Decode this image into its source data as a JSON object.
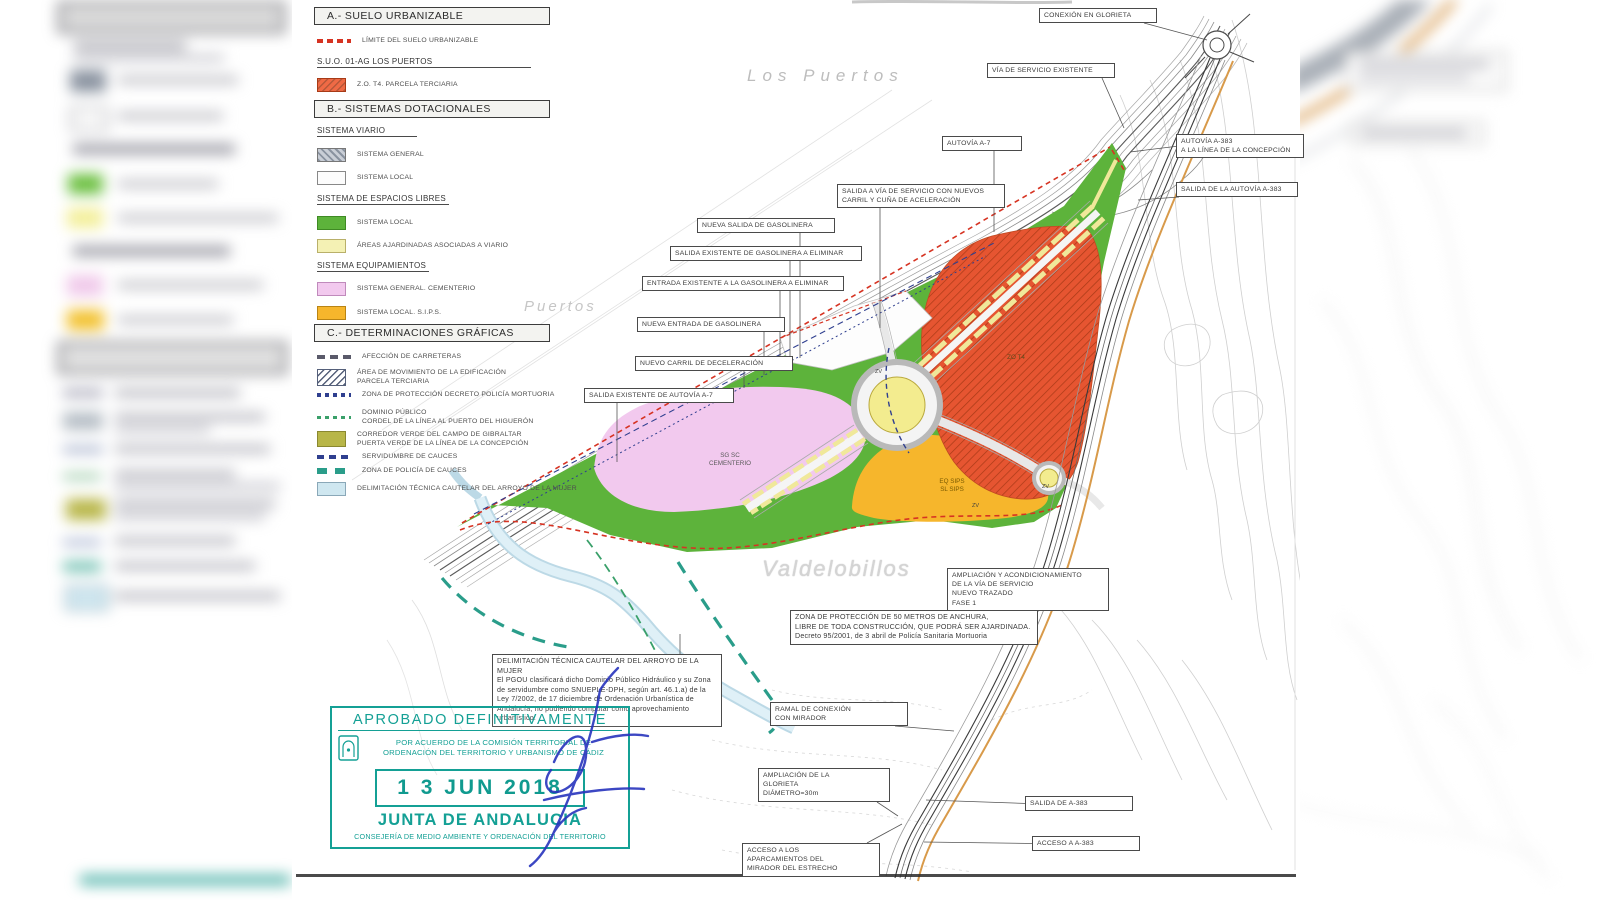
{
  "legend": {
    "header_a": "A.- SUELO URBANIZABLE",
    "limite": "LÍMITE DEL SUELO URBANIZABLE",
    "suo": "S.U.O. 01-AG  LOS PUERTOS",
    "zo_t4": "Z.O. T4. PARCELA TERCIARIA",
    "header_b": "B.- SISTEMAS DOTACIONALES",
    "viario_title": "SISTEMA VIARIO",
    "viario_general": "SISTEMA GENERAL",
    "viario_local": "SISTEMA LOCAL",
    "libres_title": "SISTEMA DE ESPACIOS LIBRES",
    "libres_local": "SISTEMA LOCAL",
    "libres_ajardinadas": "ÁREAS AJARDINADAS ASOCIADAS A VIARIO",
    "equip_title": "SISTEMA EQUIPAMIENTOS",
    "equip_cementerio": "SISTEMA GENERAL. CEMENTERIO",
    "equip_sips": "SISTEMA LOCAL. S.I.P.S.",
    "header_c": "C.- DETERMINACIONES GRÁFICAS",
    "c_afeccion": "AFECCIÓN DE CARRETERAS",
    "c_area_mov": "ÁREA DE MOVIMIENTO DE LA EDIFICACIÓN\nPARCELA TERCIARIA",
    "c_mortuoria": "ZONA DE PROTECCIÓN DECRETO POLICÍA MORTUORIA",
    "c_dominio": "DOMINIO PÚBLICO\nCORDEL DE LA LÍNEA AL PUERTO DEL HIGUERÓN",
    "c_corredor": "CORREDOR VERDE DEL CAMPO DE GIBRALTAR\nPUERTA VERDE DE LA LÍNEA DE LA CONCEPCIÓN",
    "c_servidumbre": "SERVIDUMBRE DE CAUCES",
    "c_policia": "ZONA DE POLICÍA DE CAUCES",
    "c_delimitacion": "DELIMITACIÓN TÉCNICA CAUTELAR DEL ARROYO DE LA MUJER"
  },
  "map": {
    "place_labels": {
      "los_puertos": "Los  Puertos",
      "puertos": "Puertos",
      "valdelobillos": "Valdelobillos"
    },
    "zone_labels": {
      "sg_sc": "SG SC\nCEMENTERIO",
      "eq_sips": "EQ SIPS\nSL SIPS",
      "zo_t4": "ZO T4",
      "zv": "ZV"
    },
    "callouts": {
      "conexion_glorieta": "CONEXIÓN EN GLORIETA",
      "via_servicio": "VÍA DE SERVICIO EXISTENTE",
      "autovia_a7": "AUTOVÍA A-7",
      "autovia_a383": "AUTOVÍA A-383\nA LA LÍNEA DE LA CONCEPCIÓN",
      "salida_autovia_a383": "SALIDA DE LA AUTOVÍA A-383",
      "salida_via_servicio": "SALIDA A VÍA DE SERVICIO CON NUEVOS CARRIL Y CUÑA DE ACELERACIÓN",
      "nueva_salida_gas": "NUEVA SALIDA DE GASOLINERA",
      "salida_existente_gas": "SALIDA EXISTENTE DE GASOLINERA A ELIMINAR",
      "entrada_existente_gas": "ENTRADA EXISTENTE A LA GASOLINERA A ELIMINAR",
      "nueva_entrada_gas": "NUEVA ENTRADA DE GASOLINERA",
      "nuevo_carril": "NUEVO CARRIL DE DECELERACIÓN",
      "salida_existente_autovia": "SALIDA EXISTENTE DE AUTOVÍA A-7",
      "ampliacion_via": "AMPLIACIÓN Y ACONDICIONAMIENTO\nDE LA VÍA DE SERVICIO\nNUEVO TRAZADO\nFASE 1",
      "zona_proteccion": "ZONA DE PROTECCIÓN DE 50 METROS DE ANCHURA,\nLIBRE DE TODA CONSTRUCCIÓN, QUE PODRÁ SER AJARDINADA.\nDecreto 95/2001, de 3 abril de Policía Sanitaria Mortuoria",
      "delimitacion_nota": "DELIMITACIÓN TÉCNICA CAUTELAR DEL ARROYO DE LA MUJER\nEl PGOU clasificará dicho Dominio Público Hidráulico y su Zona de servidumbre como SNUEPLE-DPH, según art. 46.1.a) de la Ley 7/2002, de 17 diciembre de Ordenación Urbanística de Andalucía, no pudiendo computar como aprovechamiento urbanístico.",
      "ramal_mirador": "RAMAL DE CONEXIÓN\nCON MIRADOR",
      "ampliacion_glorieta": "AMPLIACIÓN DE LA\nGLORIETA\nDIÁMETRO=30m",
      "salida_a383": "SALIDA DE A-383",
      "acceso_a383": "ACCESO A A-383",
      "acceso_aparcamientos": "ACCESO A LOS\nAPARCAMIENTOS DEL\nMIRADOR DEL ESTRECHO"
    }
  },
  "stamp": {
    "title": "APROBADO DEFINITIVAMENTE",
    "agreement": "POR ACUERDO DE LA COMISIÓN TERRITORIAL DE\nORDENACIÓN DEL TERRITORIO Y URBANISMO DE CÁDIZ",
    "date": "1 3  JUN  2018",
    "org": "JUNTA DE ANDALUCIA",
    "dept": "CONSEJERÍA DE MEDIO AMBIENTE Y ORDENACIÓN DEL TERRITORIO"
  },
  "colors": {
    "zone_green": "#5db33b",
    "zone_pink": "#f2c9ee",
    "zone_orange": "#f6b62c",
    "zone_red": "#e65531",
    "roundabout_yellow": "#f3ec8f",
    "areas_ajardinadas": "#f0e89a",
    "stream_blue": "#cfe7f0",
    "teal_cauces": "#2a9d8a",
    "stamp_teal": "#14a095",
    "signature_blue": "#2834bd",
    "limit_red": "#d63322"
  }
}
